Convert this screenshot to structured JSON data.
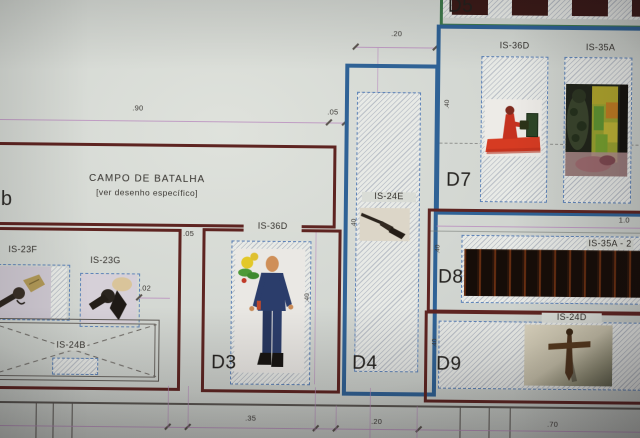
{
  "colors": {
    "maroon_border": "#5e2421",
    "blue_border": "#2f6296",
    "green_border": "#3f7a4c",
    "dashed_blue": "#5d83b8",
    "dimension_pink": "#b98cbd",
    "paper": "#d3d7d2"
  },
  "plan": {
    "marker_b": "b",
    "campo": {
      "title": "CAMPO DE BATALHA",
      "subtitle": "[ver desenho específico]"
    },
    "display_units": {
      "guns": {
        "item1": "IS-23F",
        "item2": "IS-23G",
        "item3": "IS-24B"
      },
      "d3": {
        "label": "D3",
        "item": "IS-36D"
      },
      "d4": {
        "label": "D4",
        "item": "IS-24E"
      },
      "d5": {
        "label": "D5"
      },
      "d7": {
        "label": "D7",
        "item1": "IS-36D",
        "item2": "IS-35A"
      },
      "d8": {
        "label": "D8",
        "item": "IS-35A - 2"
      },
      "d9": {
        "label": "D9",
        "item": "IS-24D"
      }
    },
    "dims": {
      "w90": ".90",
      "g05": ".05",
      "w20": ".20",
      "g05b": ".05",
      "g02": ".02",
      "b35": ".35",
      "b20": ".20",
      "b70": ".70",
      "w10": "1.0",
      "v_d3": ".40",
      "v_d4": ".40",
      "v_d7": ".40",
      "v_d8": ".40",
      "v_d9": ".40"
    },
    "photos": {
      "is23f": "revolver-photo",
      "is23g": "revolver-photo-2",
      "is36d_d3": "mannequin-photo",
      "is24e": "rifle-photo",
      "is36d_d7": "red-figure-photo",
      "is35a_d7": "soldiers-photo",
      "is35a2_d8": "artifact-strip-photo",
      "is24d": "cross-dagger-photo"
    }
  }
}
